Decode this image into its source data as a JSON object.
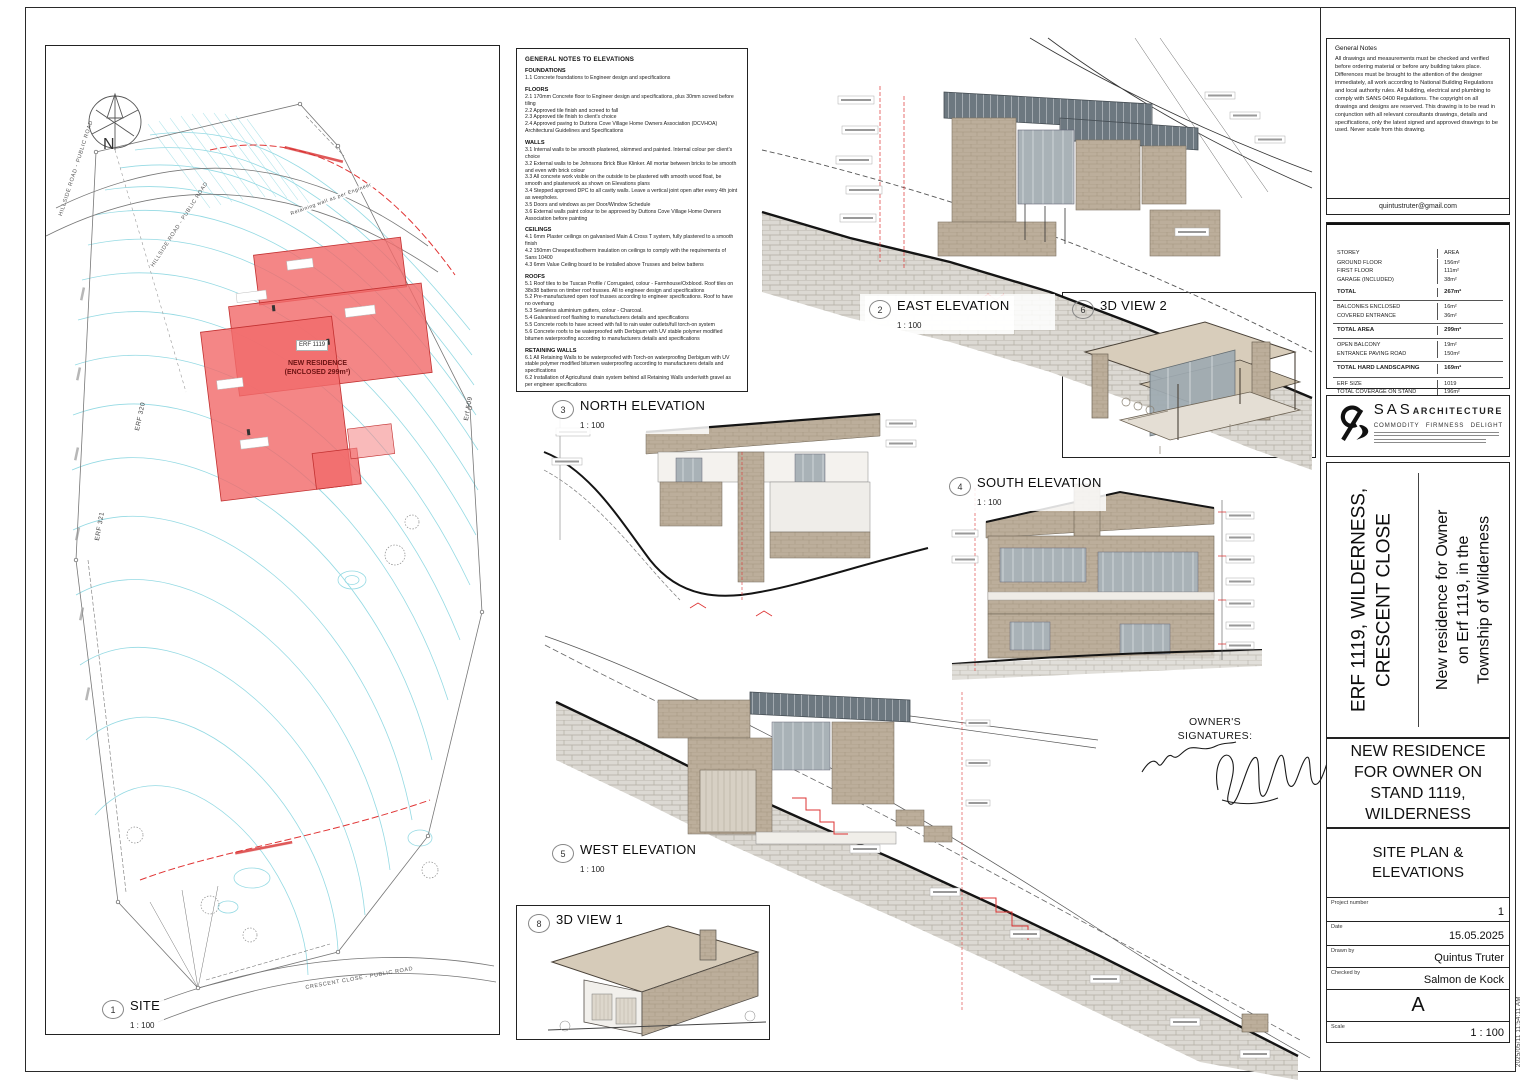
{
  "views": [
    {
      "num": "1",
      "title": "SITE",
      "scale": "1 : 100"
    },
    {
      "num": "2",
      "title": "EAST ELEVATION",
      "scale": "1 : 100"
    },
    {
      "num": "3",
      "title": "NORTH ELEVATION",
      "scale": "1 : 100"
    },
    {
      "num": "4",
      "title": "SOUTH ELEVATION",
      "scale": "1 : 100"
    },
    {
      "num": "5",
      "title": "WEST ELEVATION",
      "scale": "1 : 100"
    },
    {
      "num": "6",
      "title": "3D VIEW 2",
      "scale": ""
    },
    {
      "num": "8",
      "title": "3D VIEW 1",
      "scale": ""
    }
  ],
  "site": {
    "north": "N",
    "hillside_road": "HILLSIDE ROAD - PUBLIC ROAD",
    "crescent_close": "CRESCENT CLOSE - PUBLIC ROAD",
    "retaining": "Retaining wall as per Engineer",
    "erf_1119": "ERF 1119",
    "erf_320": "ERF 320",
    "erf_509": "Erf 509",
    "erf_321": "ERF 321",
    "new_residence": "NEW RESIDENCE\n(ENCLOSED 299m²)"
  },
  "signatures": {
    "heading": "OWNER'S\nSIGNATURES:"
  },
  "notes": {
    "title": "GENERAL NOTES TO ELEVATIONS",
    "sections": [
      {
        "heading": "FOUNDATIONS",
        "lines": [
          "1.1 Concrete foundations to Engineer design and specifications"
        ]
      },
      {
        "heading": "FLOORS",
        "lines": [
          "2.1 170mm Concrete floor to Engineer design and specifications, plus 30mm screed before tiling",
          "2.2 Approved tile finish and screed to fall",
          "2.3 Approved tile finish to client's choice",
          "2.4 Approved paving to Duttons Cove Village Home Owners Association (DCVHOA) Architectural Guidelines and Specifications"
        ]
      },
      {
        "heading": "WALLS",
        "lines": [
          "3.1 Internal walls to be smooth plastered, skimmed and painted. Internal colour per client's choice",
          "3.2 External walls to be Johnsons Brick Blue Klinker. All mortar between bricks to be smooth and even with brick colour",
          "3.3 All concrete work visible on the outside to be plastered with smooth wood float, be smooth and plasterwork as shown on Elevations plans",
          "3.4 Stepped approved DPC to all cavity walls. Leave a vertical joint open after every 4th joint as weepholes.",
          "3.5 Doors and windows as per Door/Window Schedule",
          "3.6 External walls paint colour to be approved by Duttons Cove Village Home Owners Association before painting"
        ]
      },
      {
        "heading": "CEILINGS",
        "lines": [
          "4.1 6mm Plaster ceilings on galvanised Main & Cross T system, fully plastered to a smooth finish",
          "4.2 150mm Cheapest/Isotherm insulation on ceilings to comply with the requirements of Sans 10400",
          "4.3 6mm Value Ceiling board to be installed above Trusses and below battens"
        ]
      },
      {
        "heading": "ROOFS",
        "lines": [
          "5.1 Roof tiles to be Tuscan Profile / Corrugated, colour - Farmhouse/Oxblood. Roof tiles on 38x38 battens on timber roof trusses. All to engineer design and specifications",
          "5.2 Pre-manufactured open roof trusses according to engineer specifications. Roof to have no overhang",
          "5.3 Seamless aluminium gutters, colour - Charcoal.",
          "5.4 Galvanised roof flashing to manufacturers details and specifications",
          "5.5 Concrete roofs to have screed with fall to rain water outlets/full torch-on system",
          "5.6 Concrete roofs to be waterproofed with Derbigum with UV stable polymer modified bitumen waterproofing according to manufacturers details and specifications"
        ]
      },
      {
        "heading": "RETAINING WALLS",
        "lines": [
          "6.1 All Retaining Walls to be waterproofed with Torch-on waterproofing Derbigum with UV stable polymer modified bitumen waterproofing according to manufacturers details and specifications",
          "6.2 Installation of Agricultural drain system behind all Retaining Walls under/with gravel as per engineer specifications"
        ]
      },
      {
        "heading": "WINDOWS & DOORS",
        "lines": [
          "7.1 All windows and aluminium doors colour - Charcoal. See Window/Door Schedule"
        ]
      },
      {
        "heading": "GARAGE DOORS",
        "lines": [
          "8.1 Garage doors to be Charcoal aluminium with glass as per Window & Door Schedule"
        ]
      },
      {
        "heading": "GENERAL",
        "lines": [
          "9.1 Paving as per DCVHOA Architectural Guidelines Specifications",
          "9.2 When in doubt - ask"
        ]
      }
    ]
  },
  "titleblock": {
    "general_notes_title": "General Notes",
    "general_notes": "All drawings and measurements must be checked and verified before ordering material or before any building takes place. Differences must be brought to the attention of the designer immediately, all work according to National Building Regulations and local authority rules. All building, electrical and plumbing to comply with SANS 0400 Regulations. The copyright on all drawings and designs are reserved. This drawing is to be read in conjunction with all relevant consultants drawings, details and specifications, only the latest signed and approved drawings to be used. Never scale from this drawing.",
    "email": "quintustruter@gmail.com",
    "area_table": {
      "rows": [
        {
          "label": "STOREY",
          "value": "AREA",
          "cls": "hdr"
        },
        {
          "label": "GROUND FLOOR",
          "value": "156m²"
        },
        {
          "label": "FIRST FLOOR",
          "value": "111m²"
        },
        {
          "label": "GARAGE (INCLUDED)",
          "value": "38m²"
        },
        {
          "label": "TOTAL",
          "value": "267m²",
          "cls": "b gap"
        },
        {
          "label": "BALCONIES ENCLOSED",
          "value": "16m²",
          "cls": "sep"
        },
        {
          "label": "COVERED ENTRANCE",
          "value": "36m²"
        },
        {
          "label": "TOTAL AREA",
          "value": "299m²",
          "cls": "b sep"
        },
        {
          "label": "OPEN BALCONY",
          "value": "19m²",
          "cls": "sep"
        },
        {
          "label": "ENTRANCE PAVING ROAD",
          "value": "150m²"
        },
        {
          "label": "TOTAL HARD LANDSCAPING",
          "value": "169m²",
          "cls": "b sep"
        },
        {
          "label": "ERF SIZE",
          "value": "1019",
          "cls": "sep"
        },
        {
          "label": "TOTAL COVERAGE ON STAND",
          "value": "196m²"
        },
        {
          "label": "TOTAL COVERAGE (INCLUDING BALCONIES)",
          "value": "19.2%"
        }
      ]
    },
    "logo": {
      "sas": "SAS",
      "arch": "ARCHITECTURE",
      "tag1": "COMMODITY",
      "tag2": "FIRMNESS",
      "tag3": "DELIGHT"
    },
    "erf_title": "ERF 1119, WILDERNESS,\nCRESCENT CLOSE",
    "subtitle": "New residence for Owner\non Erf 1119, in the\nTownship of Wilderness",
    "sheet_title_upper": "NEW RESIDENCE\nFOR OWNER ON\nSTAND 1119,\nWILDERNESS",
    "sheet_title_lower": "SITE PLAN &\nELEVATIONS",
    "fields": {
      "project_number_label": "Project number",
      "project_number": "1",
      "date_label": "Date",
      "date": "15.05.2025",
      "drawn_label": "Drawn by",
      "drawn": "Quintus Truter",
      "checked_label": "Checked by",
      "checked": "Salmon de Kock",
      "revision": "A",
      "scale_label": "Scale",
      "scale": "1 : 100"
    },
    "timestamp": "2025/05/11 11:54:11 AM"
  }
}
